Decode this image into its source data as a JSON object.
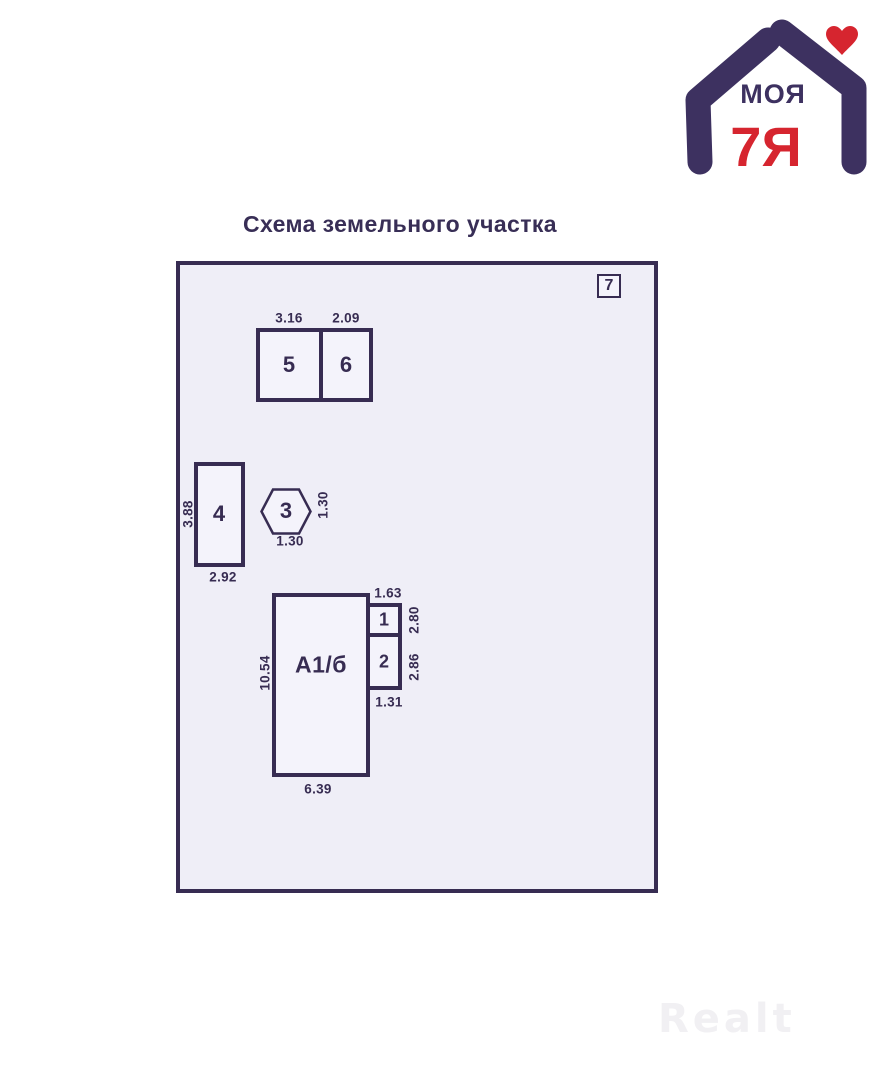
{
  "title": "Схема земельного участка",
  "logo": {
    "text_top": "МОЯ",
    "text_bottom": "7Я",
    "colors": {
      "purple": "#3d3160",
      "red": "#d6252f"
    }
  },
  "plot": {
    "corner_label": "7",
    "background": "#efeef7",
    "line_color": "#372c52",
    "buildings": {
      "b5": {
        "label": "5",
        "width": "3.16"
      },
      "b6": {
        "label": "6",
        "width": "2.09"
      },
      "b4": {
        "label": "4",
        "height": "3.88",
        "width": "2.92"
      },
      "b3": {
        "label": "3",
        "height": "1.30",
        "width": "1.30"
      },
      "main": {
        "label": "А1/б",
        "height": "10.54",
        "width": "6.39"
      },
      "b1": {
        "label": "1",
        "width": "1.63",
        "height": "2.80"
      },
      "b2": {
        "label": "2",
        "height": "2.86",
        "width": "1.31"
      }
    }
  },
  "watermark": "Realt"
}
